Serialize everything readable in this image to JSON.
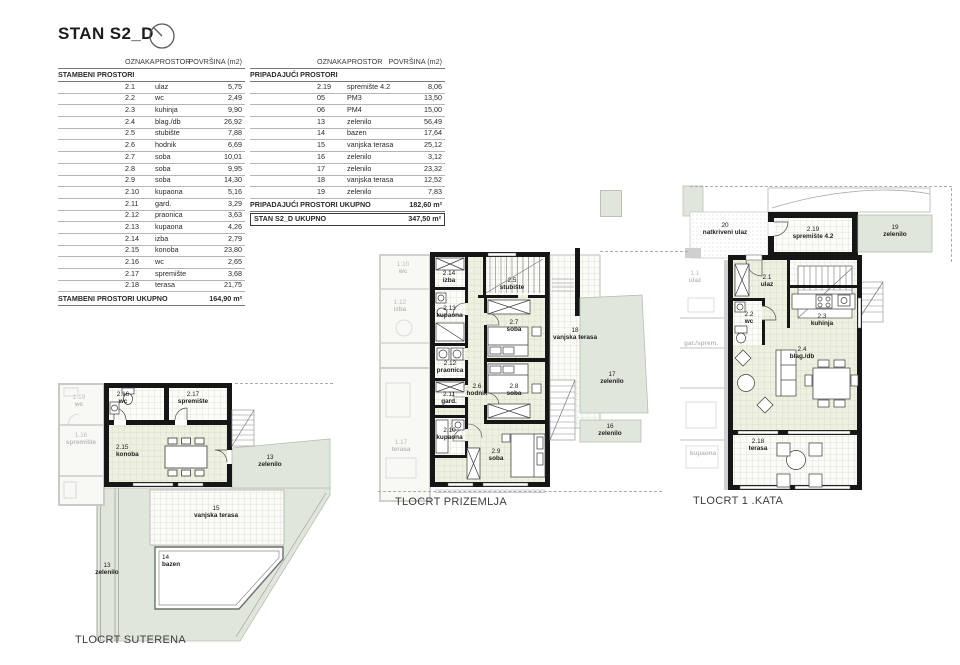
{
  "header": {
    "title": "STAN S2_D",
    "north_icon": "north-arrow"
  },
  "colors": {
    "wall": "#161616",
    "green": "#e1e6dd",
    "room_cream": "#eef0e0",
    "room_white": "#fbfbf7",
    "faded": "#c8c8c8"
  },
  "table_headers": {
    "oznaka": "OZNAKA",
    "prostor": "PROSTOR",
    "povrsina": "POVRŠINA (m2)"
  },
  "stambeni": {
    "section": "STAMBENI PROSTORI",
    "rows": [
      [
        "2.1",
        "ulaz",
        "5,75"
      ],
      [
        "2.2",
        "wc",
        "2,49"
      ],
      [
        "2.3",
        "kuhinja",
        "9,90"
      ],
      [
        "2.4",
        "blag./db",
        "26,92"
      ],
      [
        "2.5",
        "stubište",
        "7,88"
      ],
      [
        "2.6",
        "hodnik",
        "6,69"
      ],
      [
        "2.7",
        "soba",
        "10,01"
      ],
      [
        "2.8",
        "soba",
        "9,95"
      ],
      [
        "2.9",
        "soba",
        "14,30"
      ],
      [
        "2.10",
        "kupaona",
        "5,16"
      ],
      [
        "2.11",
        "gard.",
        "3,29"
      ],
      [
        "2.12",
        "praonica",
        "3,63"
      ],
      [
        "2.13",
        "kupaona",
        "4,26"
      ],
      [
        "2.14",
        "izba",
        "2,79"
      ],
      [
        "2.15",
        "konoba",
        "23,80"
      ],
      [
        "2.16",
        "wc",
        "2,65"
      ],
      [
        "2.17",
        "spremište",
        "3,68"
      ],
      [
        "2.18",
        "terasa",
        "21,75"
      ]
    ],
    "total_label": "STAMBENI PROSTORI UKUPNO",
    "total_value": "164,90 m²"
  },
  "pripadajuci": {
    "section": "PRIPADAJUĆI PROSTORI",
    "rows": [
      [
        "2.19",
        "spremište 4.2",
        "8,06"
      ],
      [
        "05",
        "PM3",
        "13,50"
      ],
      [
        "06",
        "PM4",
        "15,00"
      ],
      [
        "13",
        "zelenilo",
        "56,49"
      ],
      [
        "14",
        "bazen",
        "17,64"
      ],
      [
        "15",
        "vanjska terasa",
        "25,12"
      ],
      [
        "16",
        "zelenilo",
        "3,12"
      ],
      [
        "17",
        "zelenilo",
        "23,32"
      ],
      [
        "18",
        "vanjska terasa",
        "12,52"
      ],
      [
        "19",
        "zelenilo",
        "7,83"
      ]
    ],
    "total_label": "PRIPADAJUĆI PROSTORI UKUPNO",
    "total_value": "182,60 m²",
    "grand_label": "STAN S2_D UKUPNO",
    "grand_value": "347,50 m²"
  },
  "plans": {
    "suterena": {
      "caption": "TLOCRT SUTERENA",
      "labels": {
        "wc216": {
          "code": "2.16",
          "name": "wc"
        },
        "sprem217": {
          "code": "2.17",
          "name": "spremište"
        },
        "konoba215": {
          "code": "2.15",
          "name": "konoba"
        },
        "zelenilo13": {
          "code": "13",
          "name": "zelenilo"
        },
        "zelenilo13b": {
          "code": "13",
          "name": "zelenilo"
        },
        "terasa15": {
          "code": "15",
          "name": "vanjska terasa"
        },
        "bazen14": {
          "code": "14",
          "name": "bazen"
        },
        "neighbor_wc": {
          "code": "1.19",
          "name": "wc"
        },
        "neighbor_sprem": {
          "code": "1.16",
          "name": "spremište"
        }
      }
    },
    "prizemlje": {
      "caption": "TLOCRT PRIZEMLJA",
      "labels": {
        "izba214": {
          "code": "2.14",
          "name": "izba"
        },
        "stubiste25": {
          "code": "2.5",
          "name": "stubište"
        },
        "kupaona213": {
          "code": "2.13",
          "name": "kupaona"
        },
        "soba27": {
          "code": "2.7",
          "name": "soba"
        },
        "praonica212": {
          "code": "2.12",
          "name": "praonica"
        },
        "hodnik26": {
          "code": "2.6",
          "name": "hodnik"
        },
        "gard211": {
          "code": "2.11",
          "name": "gard."
        },
        "soba28": {
          "code": "2.8",
          "name": "soba"
        },
        "kupaona210": {
          "code": "2.10",
          "name": "kupaona"
        },
        "soba29": {
          "code": "2.9",
          "name": "soba"
        },
        "terasa18": {
          "code": "18",
          "name": "vanjska terasa"
        },
        "zelenilo17": {
          "code": "17",
          "name": "zelenilo"
        },
        "zelenilo16": {
          "code": "16",
          "name": "zelenilo"
        },
        "neighbor_wc": {
          "code": "1.10",
          "name": "wc"
        },
        "neighbor_izba": {
          "code": "1.12",
          "name": "izba"
        },
        "neighbor_terasa": {
          "code": "1.17",
          "name": "terasa"
        }
      }
    },
    "kata1": {
      "caption": "TLOCRT 1 .KATA",
      "labels": {
        "natkriveni20": {
          "code": "20",
          "name": "natkriveni ulaz"
        },
        "sprem219": {
          "code": "2.19",
          "name": "spremište 4.2"
        },
        "zelenilo19": {
          "code": "19",
          "name": "zelenilo"
        },
        "ulaz21": {
          "code": "2.1",
          "name": "ulaz"
        },
        "wc22": {
          "code": "2.2",
          "name": "wc"
        },
        "kuhinja23": {
          "code": "2.3",
          "name": "kuhinja"
        },
        "blag24": {
          "code": "2.4",
          "name": "blag./db"
        },
        "terasa218": {
          "code": "2.18",
          "name": "terasa"
        },
        "neighbor_ulaz": {
          "code": "1.1",
          "name": "ulaz"
        },
        "neighbor_gard": {
          "code": "",
          "name": "gar./sprem."
        },
        "neighbor_kupaona": {
          "code": "",
          "name": "kupaona"
        }
      }
    }
  }
}
